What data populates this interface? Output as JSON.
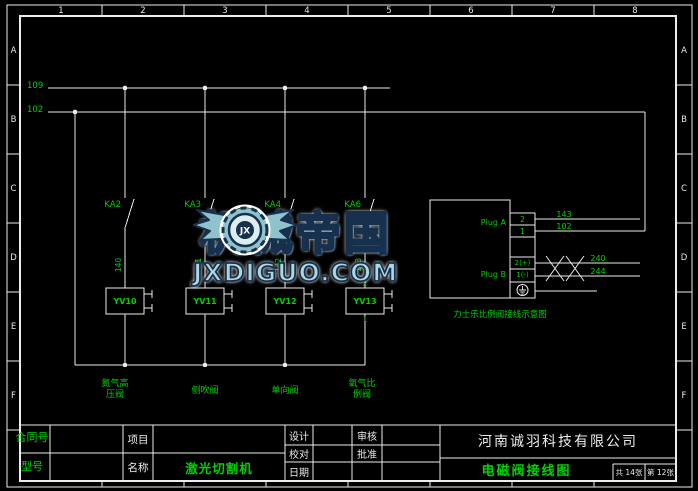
{
  "frame": {
    "top_zones": [
      "1",
      "2",
      "3",
      "4",
      "5",
      "6",
      "7",
      "8"
    ],
    "row_zones": [
      "A",
      "B",
      "C",
      "D",
      "E",
      "F"
    ]
  },
  "buses": {
    "bus1_label": "109",
    "bus2_label": "102"
  },
  "branches": [
    {
      "contact": "KA2",
      "wire_no": "140",
      "valve": "YV10",
      "caption_line1": "氮气高",
      "caption_line2": "压阀"
    },
    {
      "contact": "KA3",
      "wire_no": "141",
      "valve": "YV11",
      "caption_line1": "侧吹阀",
      "caption_line2": ""
    },
    {
      "contact": "KA4",
      "wire_no": "142",
      "valve": "YV12",
      "caption_line1": "单向阀",
      "caption_line2": ""
    },
    {
      "contact": "KA6",
      "wire_no": "143",
      "valve": "YV13",
      "caption_line1": "氧气比",
      "caption_line2": "例阀",
      "pin_top": "2",
      "pin_bottom": "1"
    }
  ],
  "plug_detail": {
    "plug_a_label": "Plug A",
    "plug_b_label": "Plug B",
    "pin_a_1": "2",
    "pin_a_2": "1",
    "pin_b_1": "2(+)",
    "pin_b_2": "1(-)",
    "wire_a_1": "143",
    "wire_a_2": "102",
    "wire_b_1": "240",
    "wire_b_2": "244",
    "note": "力士乐比例阀接线示意图"
  },
  "watermark": {
    "logo_initials": "JX",
    "title_cn": "机械帝国",
    "domain": "JXDIGUO.COM"
  },
  "title_block": {
    "contract_label": "合同号",
    "model_label": "型号",
    "project_label": "项目",
    "name_label": "名称",
    "machine_name": "激光切割机",
    "design_label": "设计",
    "proof_label": "校对",
    "date_label": "日期",
    "audit_label": "审核",
    "approve_label": "批准",
    "company": "河南诚羽科技有限公司",
    "drawing_title": "电磁阀接线图",
    "sheet_total": "共 14张",
    "sheet_index": "第 12张"
  },
  "colors": {
    "line": "#ececec",
    "green": "#00d300",
    "watermark_fill": "#aed7df",
    "watermark_outline": "#16304e"
  }
}
